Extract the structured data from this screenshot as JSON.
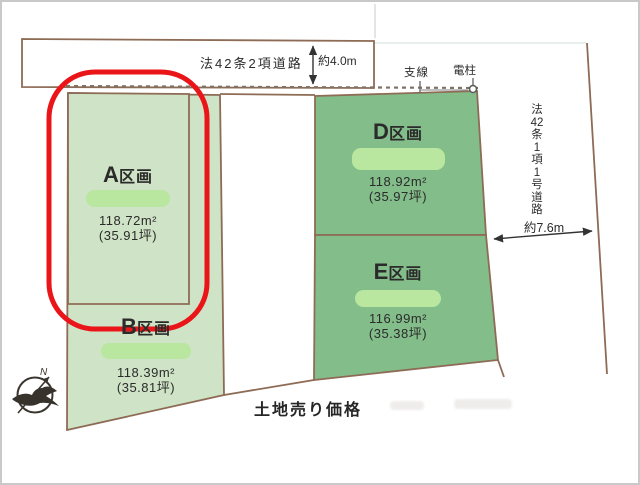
{
  "roads": {
    "top": {
      "label": "法42条2項道路",
      "width_label": "約4.0m"
    },
    "right": {
      "label": "法42条1項1号道路",
      "label_chars": [
        "法",
        "42",
        "条",
        "1",
        "項",
        "1",
        "号",
        "道",
        "路"
      ],
      "width_label": "約7.6m"
    }
  },
  "utilities": {
    "support_wire_label": "支線",
    "pole_label": "電柱"
  },
  "plots": [
    {
      "letter": "A",
      "suffix": "区画",
      "area_m2": "118.72m²",
      "area_tsubo": "(35.91坪)"
    },
    {
      "letter": "B",
      "suffix": "区画",
      "area_m2": "118.39m²",
      "area_tsubo": "(35.81坪)"
    },
    {
      "letter": "D",
      "suffix": "区画",
      "area_m2": "118.92m²",
      "area_tsubo": "(35.97坪)"
    },
    {
      "letter": "E",
      "suffix": "区画",
      "area_m2": "116.99m²",
      "area_tsubo": "(35.38坪)"
    }
  ],
  "footer": {
    "price_label": "土地売り価格"
  },
  "compass": {
    "north_label": "N"
  },
  "colors": {
    "plot_light_green": "#cfe3c6",
    "plot_dark_green": "#83bd8a",
    "price_pill_green": "#b9e79f",
    "highlight_red": "#ea1518",
    "line_brown": "#8e6b55"
  }
}
